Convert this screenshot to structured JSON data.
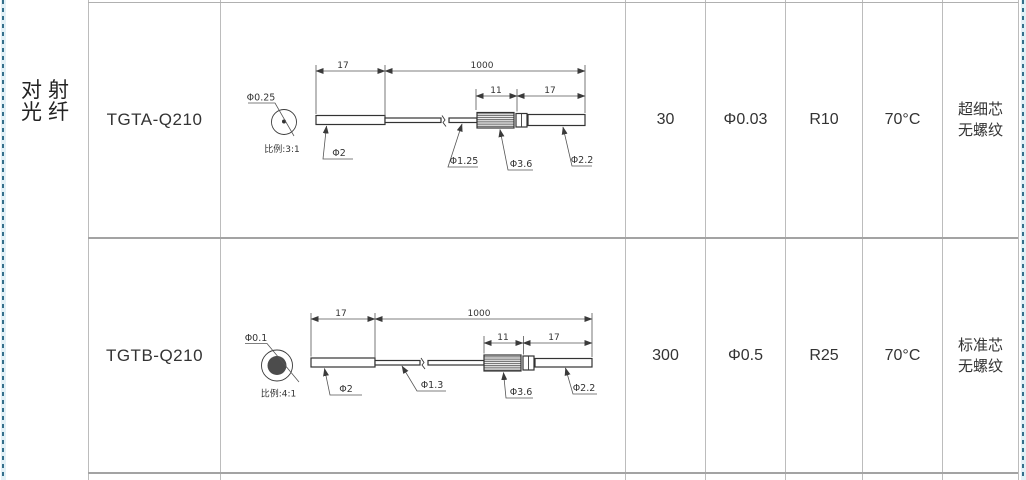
{
  "category": {
    "line1": "对射",
    "line2": "光纤"
  },
  "rows": [
    {
      "model": "TGTA-Q210",
      "drawing": {
        "core_label": "Φ0.25",
        "scale_label": "比例:3:1",
        "dim_head": "17",
        "dim_cable": "1000",
        "dim_sleeve": "11",
        "dim_tail": "17",
        "dia_head": "Φ2",
        "dia_cable": "Φ1.25",
        "dia_sleeve": "Φ3.6",
        "dia_tail": "Φ2.2"
      },
      "cols": {
        "c1": "30",
        "c2": "Φ0.03",
        "c3": "R10",
        "c4": "70°C",
        "note1": "超细芯",
        "note2": "无螺纹"
      }
    },
    {
      "model": "TGTB-Q210",
      "drawing": {
        "core_label": "Φ0.1",
        "scale_label": "比例:4:1",
        "dim_head": "17",
        "dim_cable": "1000",
        "dim_sleeve": "11",
        "dim_tail": "17",
        "dia_head": "Φ2",
        "dia_cable": "Φ1.3",
        "dia_sleeve": "Φ3.6",
        "dia_tail": "Φ2.2"
      },
      "cols": {
        "c1": "300",
        "c2": "Φ0.5",
        "c3": "R25",
        "c4": "70°C",
        "note1": "标准芯",
        "note2": "无螺纹"
      }
    }
  ]
}
